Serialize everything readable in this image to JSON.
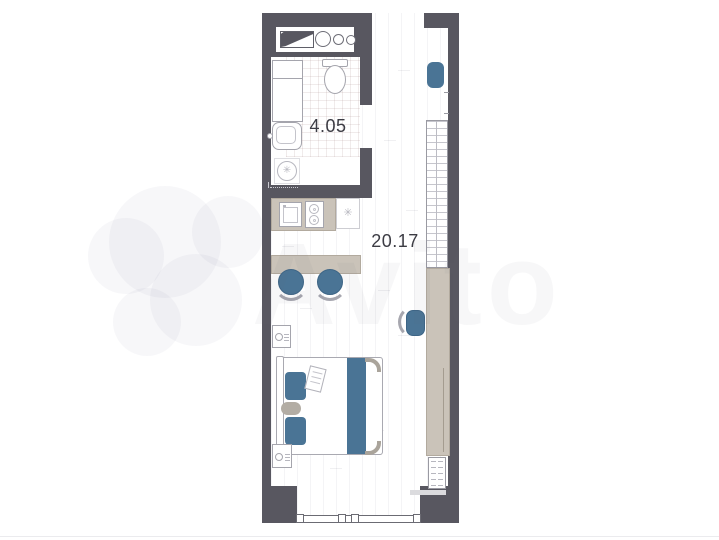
{
  "colors": {
    "wall": "#585760",
    "accent_blue": "#4a7495",
    "furniture_beige": "#cac3b9",
    "furniture_beige_border": "#b2aa9e",
    "fixture_outline": "#a5a5ad",
    "label_text": "#3c3c44"
  },
  "watermark": {
    "text": "Avito"
  },
  "icons": {
    "washing_machine_drum": "✳",
    "vent_symbol": "✳"
  },
  "plan": {
    "labels": {
      "bathroom_area": "4.05",
      "main_area": "20.17"
    },
    "furniture": [
      "utility-shaft",
      "shower",
      "bathroom-sink",
      "toilet",
      "washing-machine",
      "kitchen-counter",
      "kitchen-sink",
      "cooktop",
      "vent-cabinet",
      "dining-table",
      "stool",
      "stool",
      "entrance-pouf",
      "wardrobe",
      "desk",
      "desk-chair",
      "drawer-unit",
      "bed",
      "pillow",
      "pillow",
      "blanket",
      "nightstand",
      "nightstand",
      "window"
    ]
  }
}
